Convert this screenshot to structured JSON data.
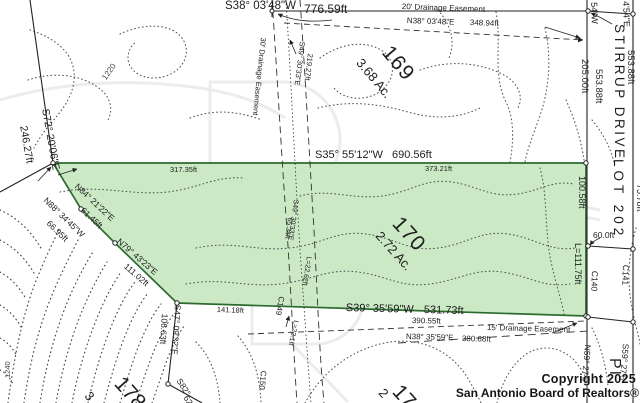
{
  "map_title": "Survey plat - Stirrup Drive lots",
  "colors": {
    "parcel_fill": "#cbe9c5",
    "parcel_stroke": "#2d6a2f",
    "line": "#222222",
    "contour": "#555555"
  },
  "parcels": {
    "subject": {
      "lot": "170",
      "acreage": "2.72 Ac."
    },
    "north": {
      "lot": "169",
      "acreage": "3.68 Ac."
    },
    "across_street": {
      "lot": "LOT 202"
    }
  },
  "street": {
    "name": "STIRRUP DRIVE"
  },
  "watermark": {
    "line1": "Copyright 2025",
    "line2": "San Antonio Board of Realtors®"
  },
  "labels": [
    {
      "n": "bearing-top-s38",
      "t": "S38° 03'48\"W",
      "x": 225,
      "y": 1,
      "r": 0,
      "s": 11.5
    },
    {
      "n": "dist-776",
      "t": "776.59ft",
      "x": 304,
      "y": 3,
      "r": 0,
      "s": 12
    },
    {
      "n": "easement-20-label",
      "t": "20' Drainage Easement",
      "x": 402,
      "y": 3,
      "r": 2,
      "s": 8
    },
    {
      "n": "bearing-n38-top",
      "t": "N38° 03'48\"E",
      "x": 407,
      "y": 17,
      "r": 2,
      "s": 8
    },
    {
      "n": "dist-348",
      "t": "348.94ft",
      "x": 470,
      "y": 19,
      "r": 2,
      "s": 8
    },
    {
      "n": "bearing-s35",
      "t": "S35° 55'12\"W",
      "x": 315,
      "y": 150,
      "r": 0,
      "s": 11
    },
    {
      "n": "dist-690",
      "t": "690.56ft",
      "x": 392,
      "y": 150,
      "r": 0,
      "s": 11
    },
    {
      "n": "dist-373",
      "t": "373.21ft",
      "x": 425,
      "y": 165,
      "r": 0,
      "s": 7.5
    },
    {
      "n": "dist-317",
      "t": "317.35ft",
      "x": 170,
      "y": 166,
      "r": 0,
      "s": 7.5
    },
    {
      "n": "bearing-s39",
      "t": "S39° 35'59\"W",
      "x": 346,
      "y": 303,
      "r": 1.5,
      "s": 11
    },
    {
      "n": "dist-531",
      "t": "531.73ft",
      "x": 424,
      "y": 305,
      "r": 1.5,
      "s": 11
    },
    {
      "n": "dist-390",
      "t": "390.55ft",
      "x": 412,
      "y": 317,
      "r": 1.5,
      "s": 8
    },
    {
      "n": "easement-15-label",
      "t": "15' Drainage Easement",
      "x": 487,
      "y": 324,
      "r": 1.5,
      "s": 8
    },
    {
      "n": "bearing-n38-bottom",
      "t": "N38° 35'59\"E",
      "x": 406,
      "y": 333,
      "r": 1.5,
      "s": 8
    },
    {
      "n": "dist-380",
      "t": "380.68ft",
      "x": 462,
      "y": 335,
      "r": 1.5,
      "s": 8
    },
    {
      "n": "dist-141",
      "t": "141.18ft",
      "x": 217,
      "y": 306,
      "r": 2,
      "s": 7.5
    },
    {
      "n": "dist-60",
      "t": "60.0ft",
      "x": 593,
      "y": 231,
      "r": 0,
      "s": 8.5
    },
    {
      "n": "bearing-partial-54w",
      "t": "54\"W",
      "x": 598,
      "y": 2,
      "r": 88,
      "s": 9
    },
    {
      "n": "bearing-partial-454e",
      "t": "4'54\"E",
      "x": 630,
      "y": 1,
      "r": 88,
      "s": 9
    },
    {
      "n": "dist-205",
      "t": "205.00ft",
      "x": 589,
      "y": 59,
      "r": 90,
      "s": 9.5
    },
    {
      "n": "dist-553-a",
      "t": "553.88ft",
      "x": 603,
      "y": 69,
      "r": 90,
      "s": 9.5
    },
    {
      "n": "dist-553-b",
      "t": "553.88ft",
      "x": 635,
      "y": 50,
      "r": 90,
      "s": 9.5
    },
    {
      "n": "street-name",
      "t": "STIRRUP DRIVE",
      "x": 626,
      "y": 24,
      "r": 90,
      "s": 13.5,
      "sp": 2.5
    },
    {
      "n": "lot-202-label",
      "t": "LOT 202",
      "x": 625,
      "y": 159,
      "r": 90,
      "s": 13.5,
      "sp": 4
    },
    {
      "n": "dist-100",
      "t": "100.58ft",
      "x": 586,
      "y": 176,
      "r": 90,
      "s": 9
    },
    {
      "n": "arc-111",
      "t": "L=111.75ft",
      "x": 582,
      "y": 243,
      "r": 90,
      "s": 9
    },
    {
      "n": "curve-c140",
      "t": "C140",
      "x": 599,
      "y": 271,
      "r": 92,
      "s": 8.5
    },
    {
      "n": "curve-c141",
      "t": "C141",
      "x": 630,
      "y": 265,
      "r": 92,
      "s": 8.5
    },
    {
      "n": "dist-75",
      "t": "75.78ft",
      "x": 644,
      "y": 184,
      "r": 90,
      "s": 9
    },
    {
      "n": "bearing-n59",
      "t": "N59° 27'5",
      "x": 592,
      "y": 345,
      "r": 95,
      "s": 8.5
    },
    {
      "n": "bearing-s59",
      "t": "S59° 27'5",
      "x": 630,
      "y": 344,
      "r": 95,
      "s": 8.5
    },
    {
      "n": "street-partial-pi",
      "t": "PI",
      "x": 622,
      "y": 358,
      "r": 90,
      "s": 16,
      "sp": 2
    },
    {
      "n": "easement-30-label",
      "t": "30' Drainage Easement",
      "x": 267,
      "y": 38,
      "r": 96,
      "s": 7.5
    },
    {
      "n": "bearing-s49-top",
      "t": "S49° 30'33\"E",
      "x": 306,
      "y": 42,
      "r": 97,
      "s": 7.5
    },
    {
      "n": "dist-219",
      "t": "219.27ft",
      "x": 314,
      "y": 54,
      "r": 97,
      "s": 7.5
    },
    {
      "n": "bearing-s49-mid",
      "t": "S49° 30'33\"E",
      "x": 299,
      "y": 200,
      "r": 98,
      "s": 7
    },
    {
      "n": "dist-65",
      "t": "65.34ft",
      "x": 293,
      "y": 218,
      "r": 98,
      "s": 7
    },
    {
      "n": "arc-2262",
      "t": "L=22.62ft",
      "x": 312,
      "y": 257,
      "r": 99,
      "s": 7
    },
    {
      "n": "curve-c149",
      "t": "C149",
      "x": 285,
      "y": 297,
      "r": 100,
      "s": 8
    },
    {
      "n": "arc-221",
      "t": "L=22.1ft",
      "x": 299,
      "y": 321,
      "r": 102,
      "s": 7
    },
    {
      "n": "curve-c150",
      "t": "C150",
      "x": 267,
      "y": 371,
      "r": 95,
      "s": 8
    },
    {
      "n": "bearing-s72",
      "t": "S72° 20'06\"E",
      "x": 50,
      "y": 108,
      "r": 80,
      "s": 10.5
    },
    {
      "n": "dist-246",
      "t": "246.27ft",
      "x": 28,
      "y": 125,
      "r": 80,
      "s": 10.5
    },
    {
      "n": "contour-1220",
      "t": "1220",
      "x": 101,
      "y": 77,
      "r": -55,
      "s": 8,
      "c": "#444444"
    },
    {
      "n": "contour-1240",
      "t": "1240",
      "x": 4,
      "y": 378,
      "r": -90,
      "s": 7.5,
      "c": "#444444"
    },
    {
      "n": "bearing-n84",
      "t": "N84° 21'22\"E",
      "x": 79,
      "y": 182,
      "r": 43,
      "s": 8.5
    },
    {
      "n": "dist-6145",
      "t": "61.45ft",
      "x": 85,
      "y": 206,
      "r": 43,
      "s": 8.5
    },
    {
      "n": "bearing-n79",
      "t": "N79° 43'23\"E",
      "x": 121,
      "y": 237,
      "r": 41,
      "s": 8.5
    },
    {
      "n": "dist-11102",
      "t": "111.02ft",
      "x": 128,
      "y": 262,
      "r": 41,
      "s": 8.5
    },
    {
      "n": "bearing-n88",
      "t": "N88° 34'45\"W",
      "x": 48,
      "y": 196,
      "r": 44,
      "s": 8.5
    },
    {
      "n": "dist-6695",
      "t": "66.95ft",
      "x": 51,
      "y": 219,
      "r": 44,
      "s": 8.5
    },
    {
      "n": "bearing-s47",
      "t": "S47° 09'32\"E",
      "x": 182,
      "y": 305,
      "r": 94,
      "s": 8.5
    },
    {
      "n": "dist-10663",
      "t": "106.63ft",
      "x": 169,
      "y": 314,
      "r": 94,
      "s": 8.5
    },
    {
      "n": "bearing-s82-partial",
      "t": "S82°",
      "x": 182,
      "y": 377,
      "r": 57,
      "s": 8.5
    },
    {
      "n": "dist-62-partial",
      "t": "62",
      "x": 189,
      "y": 394,
      "r": 57,
      "s": 8.5
    },
    {
      "n": "lot-169-number",
      "t": "169",
      "x": 394,
      "y": 42,
      "r": 50,
      "s": 21,
      "sp": 1
    },
    {
      "n": "lot-169-acreage",
      "t": "3.68 Ac.",
      "x": 364,
      "y": 56,
      "r": 50,
      "s": 13
    },
    {
      "n": "lot-170-number",
      "t": "170",
      "x": 404,
      "y": 213,
      "r": 48,
      "s": 21,
      "sp": 1
    },
    {
      "n": "lot-170-acreage",
      "t": "2.72 Ac.",
      "x": 383,
      "y": 229,
      "r": 48,
      "s": 13
    },
    {
      "n": "lot-17x-number-partial",
      "t": "17",
      "x": 404,
      "y": 381,
      "r": 48,
      "s": 21
    },
    {
      "n": "lot-17x-acreage-partial",
      "t": "2",
      "x": 386,
      "y": 386,
      "r": 48,
      "s": 13
    },
    {
      "n": "lot-178-number-partial",
      "t": "178",
      "x": 126,
      "y": 373,
      "r": 48,
      "s": 21
    },
    {
      "n": "lot-178-acreage-partial",
      "t": "3",
      "x": 92,
      "y": 389,
      "r": 48,
      "s": 13
    }
  ]
}
